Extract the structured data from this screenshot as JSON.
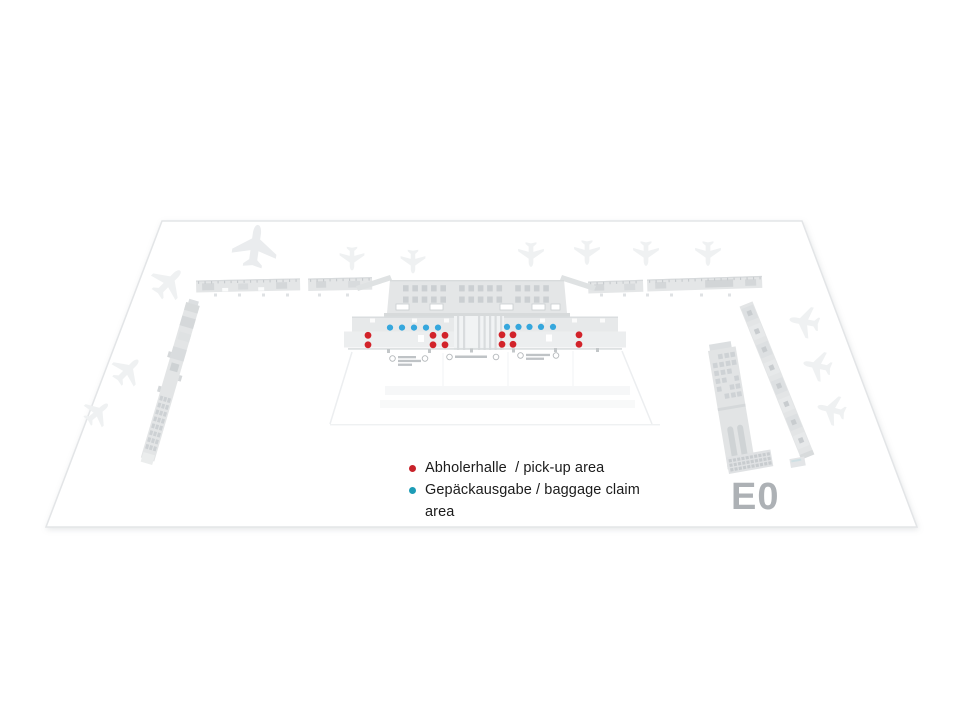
{
  "map": {
    "level_label": "E0",
    "legend": [
      {
        "id": "pickup",
        "label": "Abholerhalle  / pick-up area",
        "color": "#c8222a"
      },
      {
        "id": "baggage",
        "label": "Gepäckausgabe / baggage claim\narea",
        "color": "#1d9cb6"
      }
    ],
    "markers": {
      "baggage": {
        "color": "#36a7dd",
        "radius": 3.1,
        "points": [
          [
            390,
            327.6
          ],
          [
            402,
            327.6
          ],
          [
            414,
            327.6
          ],
          [
            426,
            327.6
          ],
          [
            438,
            327.6
          ],
          [
            507,
            326.9
          ],
          [
            518.5,
            326.9
          ],
          [
            529.5,
            326.9
          ],
          [
            541,
            326.9
          ],
          [
            553,
            326.9
          ]
        ]
      },
      "pickup": {
        "color": "#d2232a",
        "radius": 3.4,
        "points": [
          [
            368,
            335.3
          ],
          [
            368,
            344.8
          ],
          [
            433,
            335.3
          ],
          [
            445,
            335.3
          ],
          [
            433,
            344.8
          ],
          [
            445,
            344.8
          ],
          [
            502,
            334.8
          ],
          [
            513,
            334.8
          ],
          [
            502,
            344.3
          ],
          [
            513,
            344.3
          ],
          [
            579,
            334.8
          ],
          [
            579,
            344.3
          ]
        ]
      }
    },
    "theme": {
      "ground_fill": "#ffffff",
      "ground_stroke": "#e3e5e7",
      "building_fill": "#e3e5e6",
      "building_detail": "#d2d6d8",
      "plane_fill": "#eff1f2",
      "level_label_color": "#adb1b5"
    }
  }
}
